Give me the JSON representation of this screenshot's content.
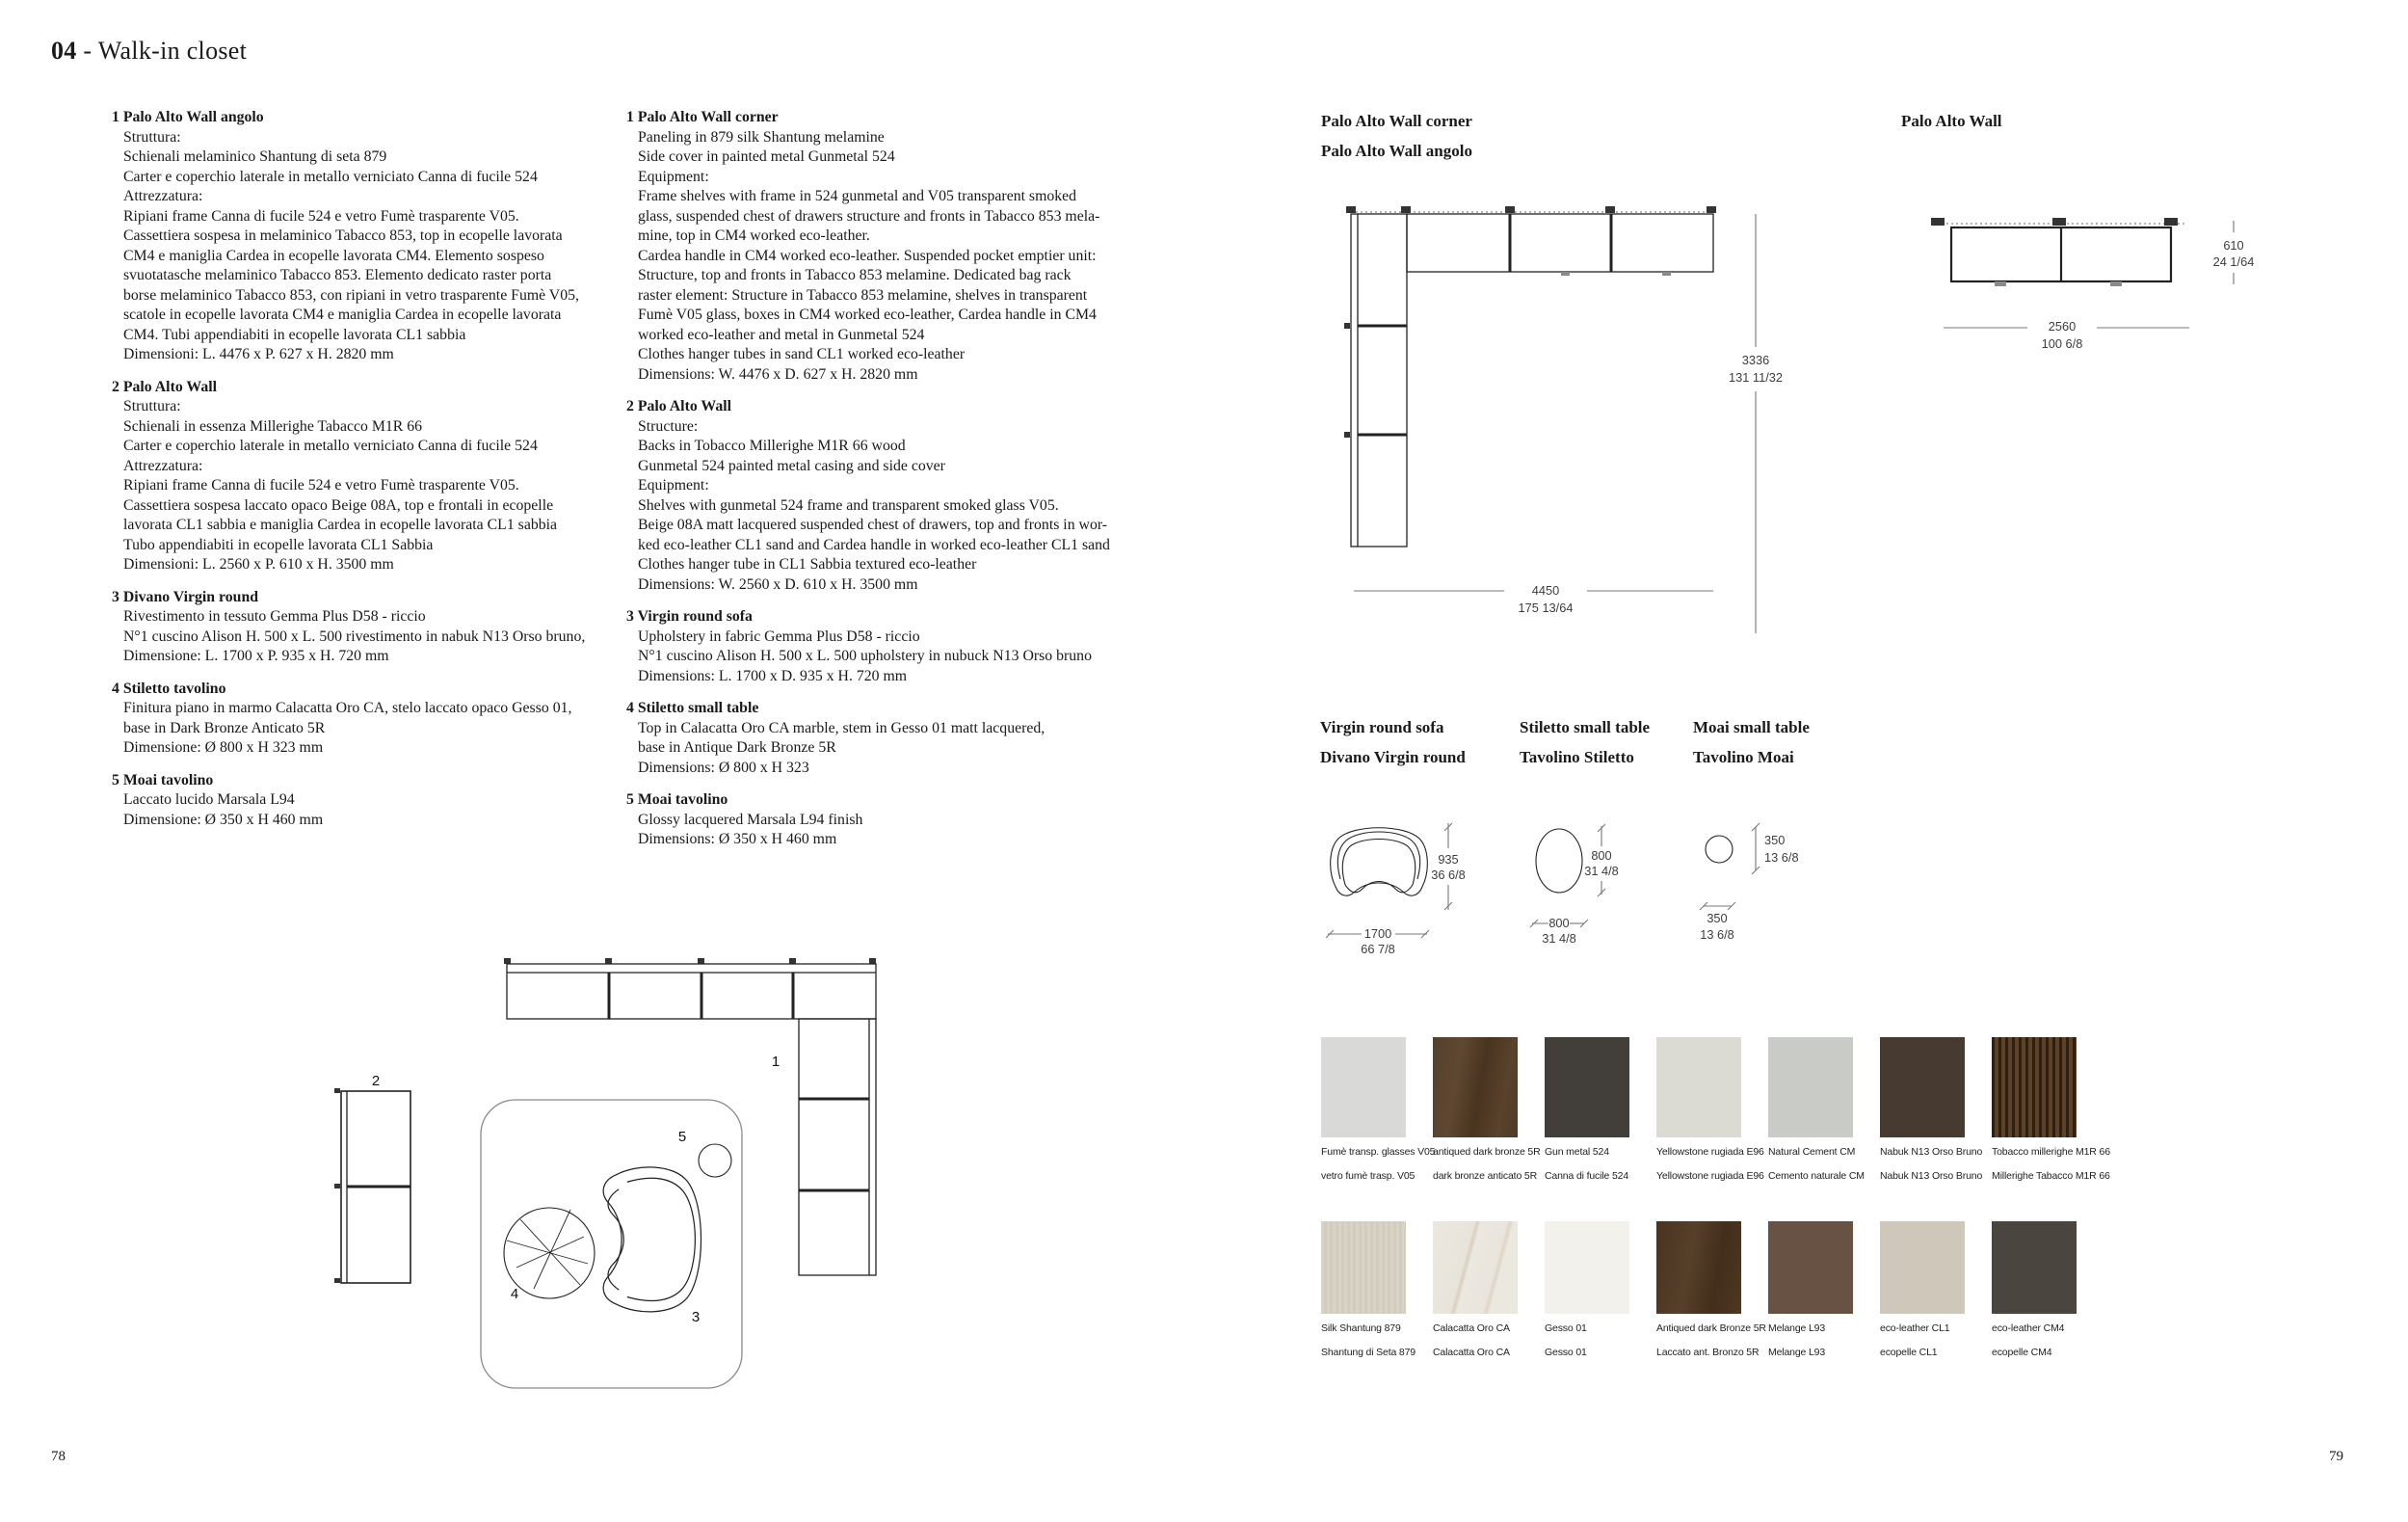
{
  "page": {
    "title_num": "04",
    "title_rest": " - Walk-in closet",
    "page_left": "78",
    "page_right": "79"
  },
  "specs_it": [
    {
      "num": "1",
      "title": "Palo Alto Wall angolo",
      "body": "Struttura:\nSchienali melaminico Shantung di seta 879\nCarter e coperchio laterale in metallo verniciato Canna di fucile 524\nAttrezzatura:\nRipiani frame Canna di fucile 524 e vetro Fumè trasparente V05.\nCassettiera sospesa in melaminico Tabacco 853, top in ecopelle lavorata\nCM4 e maniglia Cardea in ecopelle lavorata CM4. Elemento sospeso\nsvuotatasche melaminico Tabacco 853. Elemento dedicato raster porta\nborse melaminico Tabacco 853, con ripiani in vetro trasparente Fumè V05,\nscatole in ecopelle lavorata CM4 e maniglia Cardea in ecopelle lavorata\nCM4. Tubi appendiabiti in ecopelle lavorata CL1 sabbia\nDimensioni: L. 4476 x P. 627 x H. 2820 mm"
    },
    {
      "num": "2",
      "title": "Palo Alto Wall",
      "body": "Struttura:\nSchienali in essenza Millerighe Tabacco M1R 66\nCarter e coperchio laterale in metallo verniciato Canna di fucile 524\nAttrezzatura:\nRipiani frame Canna di fucile 524 e vetro Fumè trasparente V05.\nCassettiera sospesa laccato opaco Beige 08A, top e frontali in ecopelle\nlavorata CL1 sabbia e maniglia Cardea in ecopelle lavorata CL1 sabbia\nTubo appendiabiti in ecopelle lavorata CL1 Sabbia\nDimensioni: L. 2560 x P. 610 x H. 3500 mm"
    },
    {
      "num": "3",
      "title": "Divano Virgin round",
      "body": "Rivestimento in tessuto Gemma Plus D58 - riccio\nN°1 cuscino Alison H. 500 x L. 500 rivestimento in nabuk N13 Orso bruno,\nDimensione: L. 1700 x P. 935 x H. 720 mm"
    },
    {
      "num": "4",
      "title": "Stiletto tavolino",
      "body": "Finitura piano in marmo Calacatta Oro CA, stelo laccato opaco Gesso 01,\nbase in Dark Bronze Anticato 5R\nDimensione: Ø 800 x H 323 mm"
    },
    {
      "num": "5",
      "title": "Moai tavolino",
      "body": "Laccato lucido Marsala L94\nDimensione: Ø 350 x H 460 mm"
    }
  ],
  "specs_en": [
    {
      "num": "1",
      "title": "Palo Alto Wall corner",
      "body": "Paneling in 879 silk Shantung melamine\nSide cover in painted metal Gunmetal 524\nEquipment:\nFrame shelves with frame in 524 gunmetal and V05 transparent smoked\nglass, suspended chest of drawers structure and fronts in Tabacco 853 mela-\nmine, top in CM4 worked eco-leather.\nCardea handle in CM4 worked eco-leather. Suspended pocket emptier unit:\nStructure, top and fronts in Tabacco 853 melamine. Dedicated bag rack\nraster element: Structure in Tabacco 853 melamine, shelves in transparent\nFumè V05 glass, boxes in CM4 worked eco-leather, Cardea handle in CM4\nworked eco-leather and metal in Gunmetal 524\nClothes hanger tubes in sand CL1 worked eco-leather\nDimensions: W. 4476 x D. 627 x H. 2820 mm"
    },
    {
      "num": "2",
      "title": "Palo Alto Wall",
      "body": "Structure:\nBacks in Tobacco Millerighe M1R 66 wood\nGunmetal 524 painted metal casing and side cover\nEquipment:\nShelves with gunmetal 524 frame and transparent smoked glass V05.\nBeige 08A matt lacquered suspended chest of drawers, top and fronts in wor-\nked eco-leather CL1 sand and Cardea handle in worked eco-leather CL1 sand\nClothes hanger tube in CL1 Sabbia textured eco-leather\nDimensions: W. 2560 x D. 610 x H. 3500 mm"
    },
    {
      "num": "3",
      "title": "Virgin round sofa",
      "body": "Upholstery in fabric Gemma Plus D58 - riccio\nN°1 cuscino Alison H. 500 x L. 500 upholstery in nubuck N13 Orso bruno\nDimensions: L. 1700 x D. 935 x H. 720 mm"
    },
    {
      "num": "4",
      "title": "Stiletto small table",
      "body": "Top in Calacatta Oro CA marble, stem in Gesso 01 matt lacquered,\nbase in Antique Dark Bronze 5R\nDimensions: Ø 800 x H 323"
    },
    {
      "num": "5",
      "title": "Moai tavolino",
      "body": "Glossy lacquered Marsala L94 finish\nDimensions: Ø 350 x H 460 mm"
    }
  ],
  "drawings": {
    "corner": {
      "title_en": "Palo Alto Wall corner",
      "title_it": "Palo Alto Wall angolo",
      "height_mm": "3336",
      "height_in": "131 11/32",
      "width_mm": "4450",
      "width_in": "175 13/64"
    },
    "wall": {
      "title": "Palo Alto Wall",
      "depth_mm": "610",
      "depth_in": "24 1/64",
      "width_mm": "2560",
      "width_in": "100 6/8"
    },
    "sofa": {
      "title_en": "Virgin round sofa",
      "title_it": "Divano Virgin round",
      "depth_mm": "935",
      "depth_in": "36 6/8",
      "width_mm": "1700",
      "width_in": "66 7/8"
    },
    "stiletto": {
      "title_en": "Stiletto small table",
      "title_it": "Tavolino Stiletto",
      "diameter_mm": "800",
      "diameter_in": "31 4/8",
      "width_mm": "800",
      "width_in": "31 4/8"
    },
    "moai": {
      "title_en": "Moai small table",
      "title_it": "Tavolino Moai",
      "diameter_mm": "350",
      "diameter_in": "13 6/8",
      "width_mm": "350",
      "width_in": "13 6/8"
    }
  },
  "floorplan": {
    "labels": {
      "corner_unit": "1",
      "wall_unit": "2",
      "sofa": "3",
      "stiletto": "4",
      "moai": "5"
    }
  },
  "swatches": {
    "row1": [
      {
        "en": "Fumè transp. glasses V05",
        "it": "vetro fumè trasp. V05",
        "bg": "#d9d9d7"
      },
      {
        "en": "antiqued dark bronze 5R",
        "it": "dark bronze anticato 5R",
        "bg": "linear-gradient(100deg,#53402c,#5f4832 30%,#49341f 55%,#5a422c 80%,#4e3a26)"
      },
      {
        "en": "Gun metal 524",
        "it": "Canna di fucile 524",
        "bg": "#423e39"
      },
      {
        "en": "Yellowstone rugiada E96",
        "it": "Yellowstone rugiada E96",
        "bg": "#dcdbd3"
      },
      {
        "en": "Natural Cement CM",
        "it": "Cemento naturale CM",
        "bg": "#c8cbc6"
      },
      {
        "en": "Nabuk N13 Orso Bruno",
        "it": "Nabuk N13 Orso Bruno",
        "bg": "#473a31"
      },
      {
        "en": "Tobacco millerighe M1R 66",
        "it": "Millerighe Tabacco  M1R 66",
        "bg": "repeating-linear-gradient(90deg,#2e1f11 0px,#2e1f11 3px,#5b4228 3px,#5b4228 7px)"
      }
    ],
    "row2": [
      {
        "en": "Silk Shantung 879",
        "it": "Shantung di Seta 879",
        "bg": "repeating-linear-gradient(90deg,#d8d3c7 0px,#d8d3c7 3px,#d1ccbe 3px,#d1ccbe 6px)"
      },
      {
        "en": "Calacatta Oro CA",
        "it": "Calacatta Oro CA",
        "bg": "linear-gradient(105deg,#ebe8e0 0%,#e8e4da 38%,#d8d0bf 41%,#ebe8e0 44%,#e9e5dc 68%,#ddd5c6 71%,#ebe8e0 74%)"
      },
      {
        "en": "Gesso 01",
        "it": "Gesso 01",
        "bg": "#f2f1eb"
      },
      {
        "en": "Antiqued dark Bronze 5R",
        "it": "Laccato ant. Bronzo 5R",
        "bg": "linear-gradient(100deg,#4a3420,#56402a 40%,#432e1b 70%,#4e3824)"
      },
      {
        "en": "Melange L93",
        "it": "Melange L93",
        "bg": "#675243"
      },
      {
        "en": "eco-leather CL1",
        "it": "ecopelle CL1",
        "bg": "#cec7ba"
      },
      {
        "en": "eco-leather CM4",
        "it": "ecopelle CM4",
        "bg": "#4b4540"
      }
    ]
  }
}
